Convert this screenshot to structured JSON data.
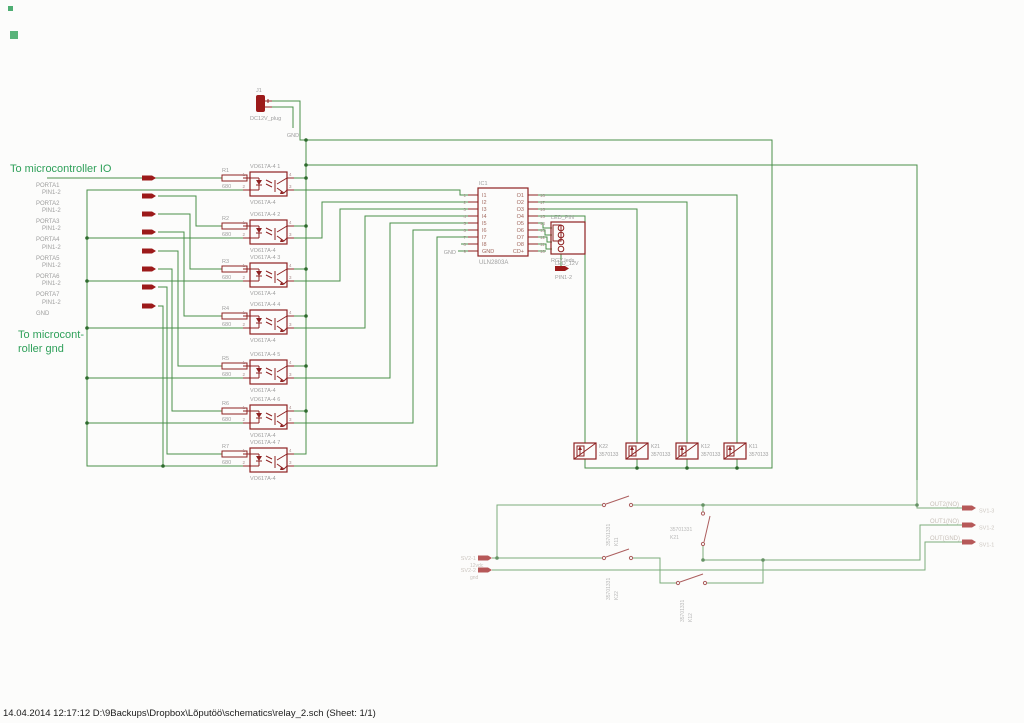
{
  "colors": {
    "wire": "#4a8f4a",
    "symbol": "#8e2222",
    "pin_marker": "#9c1a1a",
    "label_gray": "#9e9e9e",
    "annotation_green": "#2fa05a",
    "junction": "#2e6b2e",
    "faded_label": "#b3a89e",
    "background": "#fcfcfb"
  },
  "annotations": {
    "io_title": "To microcontroller IO",
    "gnd_title_line1": "To microcont-",
    "gnd_title_line2": "roller gnd"
  },
  "status_bar": "14.04.2014 12:17:12  D:\\9Backups\\Dropbox\\Lõputöö\\schematics\\relay_2.sch (Sheet: 1/1)",
  "power_plug": {
    "name": "J1",
    "value": "DC12V_plug",
    "gnd_net": "GND"
  },
  "ports": [
    {
      "pin": "",
      "name": "PORTA1"
    },
    {
      "pin": "PIN1-2",
      "name": "PORTA2"
    },
    {
      "pin": "PIN1-2",
      "name": "PORTA3"
    },
    {
      "pin": "PIN1-2",
      "name": "PORTA4"
    },
    {
      "pin": "PIN1-2",
      "name": "PORTA5"
    },
    {
      "pin": "PIN1-2",
      "name": "PORTA6"
    },
    {
      "pin": "PIN1-2",
      "name": "PORTA7"
    },
    {
      "pin": "PIN1-2",
      "name": "GND"
    }
  ],
  "optocouplers": [
    {
      "name": "VO617A-4 1",
      "value": "VO617A-4",
      "resistor": "R1",
      "resistance": "680"
    },
    {
      "name": "VO617A-4 2",
      "value": "VO617A-4",
      "resistor": "R2",
      "resistance": "680"
    },
    {
      "name": "VO617A-4 3",
      "value": "VO617A-4",
      "resistor": "R3",
      "resistance": "680"
    },
    {
      "name": "VO617A-4 4",
      "value": "VO617A-4",
      "resistor": "R4",
      "resistance": "680"
    },
    {
      "name": "VO617A-4 5",
      "value": "VO617A-4",
      "resistor": "R5",
      "resistance": "680"
    },
    {
      "name": "VO617A-4 6",
      "value": "VO617A-4",
      "resistor": "R6",
      "resistance": "680"
    },
    {
      "name": "VO617A-4 7",
      "value": "VO617A-4",
      "resistor": "R7",
      "resistance": "680"
    }
  ],
  "opto_pin_digits": [
    "1",
    "2",
    "4",
    "3"
  ],
  "driver_ic": {
    "name": "IC1",
    "value": "ULN2803A",
    "gnd_net": "GND",
    "left_pin_numbers": [
      "1",
      "2",
      "3",
      "4",
      "5",
      "6",
      "7",
      "8",
      "9"
    ],
    "left_pin_names": [
      "I1",
      "I2",
      "I3",
      "I4",
      "I5",
      "I6",
      "I7",
      "I8",
      "GND"
    ],
    "right_pin_numbers": [
      "18",
      "17",
      "16",
      "15",
      "14",
      "13",
      "12",
      "11",
      "10"
    ],
    "right_pin_names": [
      "O1",
      "O2",
      "O3",
      "O4",
      "O5",
      "O6",
      "O7",
      "O8",
      "CD+"
    ]
  },
  "led_header": {
    "name": "LED_PIN",
    "value": "RGY leds"
  },
  "led_port": {
    "label": "LED_12V",
    "pin": "PIN1-2"
  },
  "relay_coils": [
    {
      "name": "K22",
      "value": "3570133"
    },
    {
      "name": "K21",
      "value": "3570133"
    },
    {
      "name": "K12",
      "value": "3570133"
    },
    {
      "name": "K11",
      "value": "3570133"
    }
  ],
  "relay_contacts": [
    {
      "name": "K11",
      "value": "35701331"
    },
    {
      "name": "K21",
      "value": "35701331"
    },
    {
      "name": "K22",
      "value": "35701331"
    },
    {
      "name": "K12",
      "value": "35701331"
    }
  ],
  "input_pins": [
    {
      "name": "SV2-1",
      "net": "12vdc"
    },
    {
      "name": "SV2-2",
      "net": "gnd"
    }
  ],
  "output_pins": [
    {
      "label": "OUT2(NO)",
      "pin": "SV1-3"
    },
    {
      "label": "OUT1(NO)",
      "pin": "SV1-2"
    },
    {
      "label": "OUT(GND)",
      "pin": "SV1-1"
    }
  ]
}
